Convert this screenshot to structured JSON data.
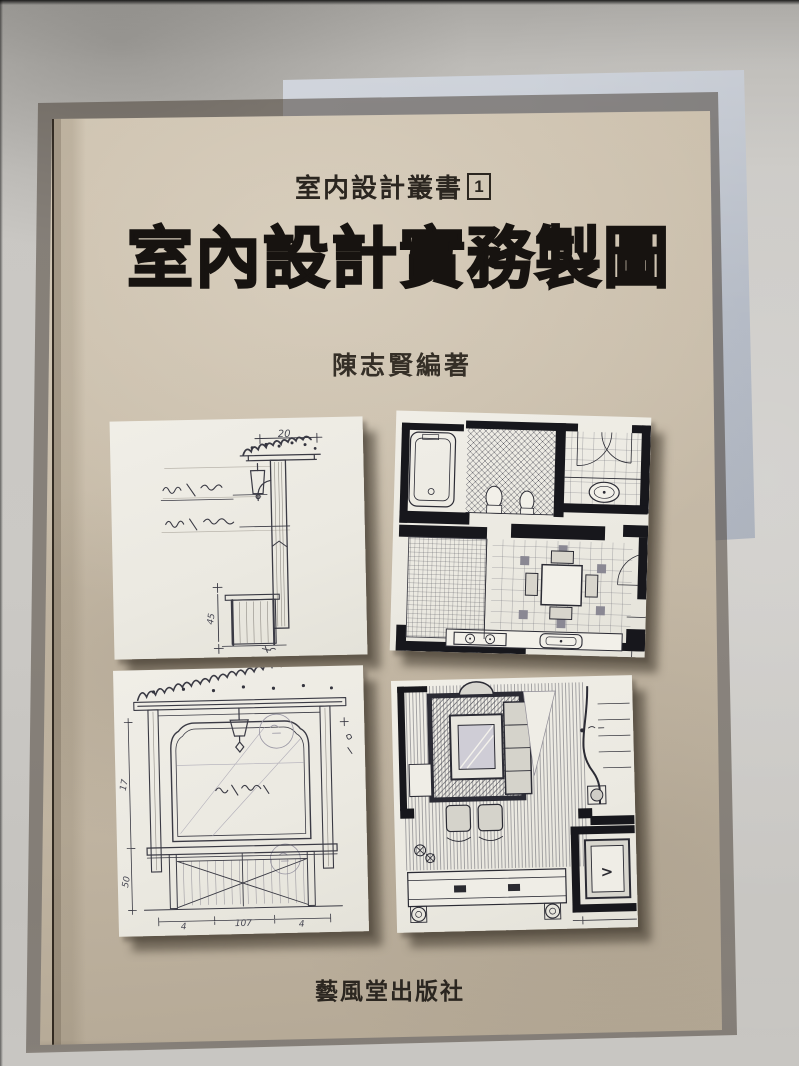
{
  "scene": {
    "description": "Photograph of a paperback book lying on a gray surface, a translucent sheet protruding at its top-right",
    "surface_color": "#c7c5c1",
    "cover_color": "#c5b9a6",
    "panel_paper_color": "#edebe3",
    "ink_color": "#34343e",
    "title_ink_color": "#171310",
    "sheet_color": "#c2c8d1"
  },
  "cover": {
    "series_label": "室内設計叢書",
    "series_number": "1",
    "title": "室內設計實務製圖",
    "author": "陳志賢編著",
    "publisher": "藝風堂出版社",
    "panels": [
      {
        "name": "pergola-post-lamp-bench-elevation-sketch",
        "dims": [
          "20",
          "45"
        ]
      },
      {
        "name": "bathroom-kitchen-dining-floor-plan-sketch",
        "dims": []
      },
      {
        "name": "arched-alcove-bench-elevation-sketch",
        "dims": [
          "17",
          "50",
          "4",
          "107",
          "4"
        ]
      },
      {
        "name": "living-room-furniture-floor-plan-sketch",
        "dims": [],
        "mark": ">"
      }
    ]
  }
}
